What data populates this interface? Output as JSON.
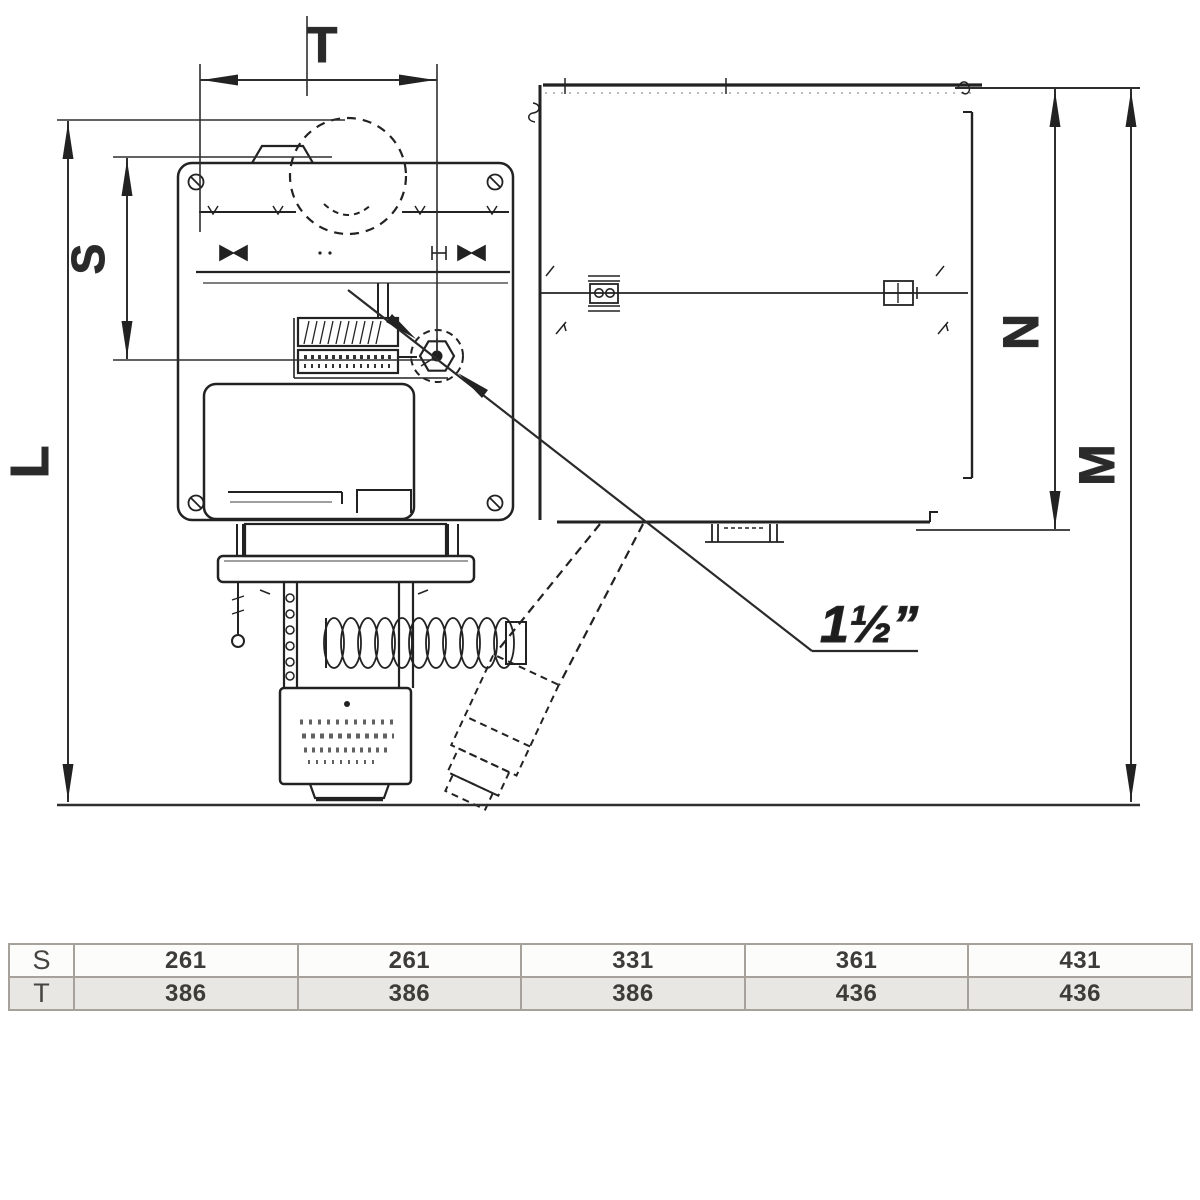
{
  "drawing": {
    "dim_labels": {
      "T": "T",
      "S": "S",
      "L": "L",
      "N": "N",
      "M": "M"
    },
    "connection_label": "1½”"
  },
  "table": {
    "rows": [
      {
        "label": "S",
        "values": [
          "261",
          "261",
          "331",
          "361",
          "431"
        ]
      },
      {
        "label": "T",
        "values": [
          "386",
          "386",
          "386",
          "436",
          "436"
        ]
      }
    ]
  },
  "colors": {
    "line": "#222222",
    "dim": "#2e2e2e",
    "table_border": "#a6a19b",
    "row_s_bg": "#fcfcfb",
    "row_t_bg": "#e9e7e4",
    "table_text": "#3e3c39"
  }
}
